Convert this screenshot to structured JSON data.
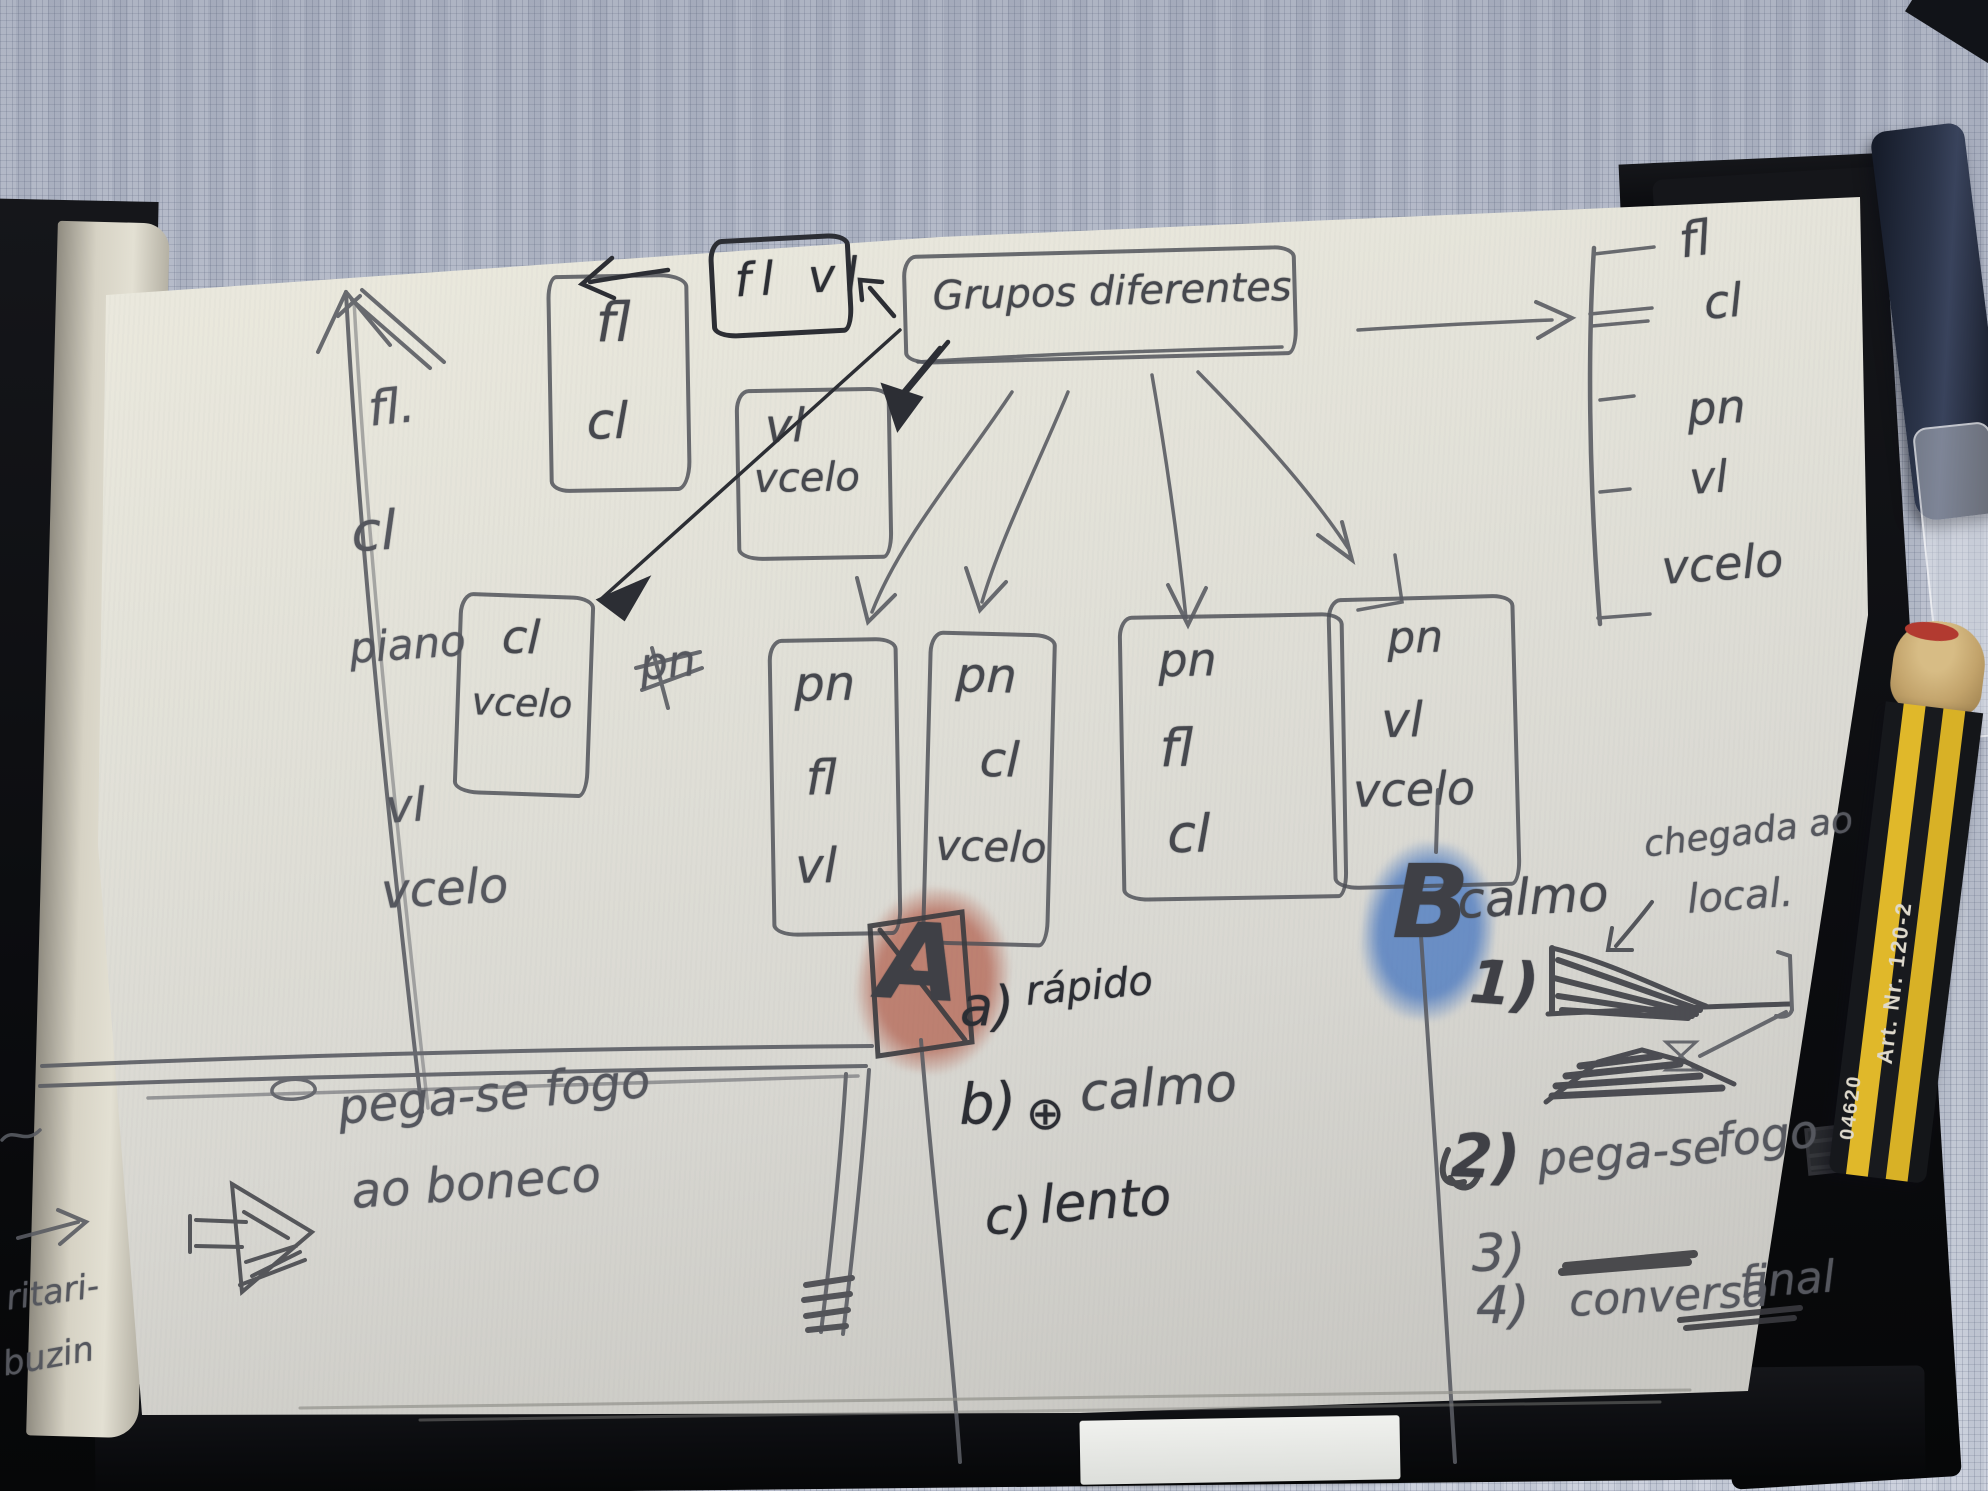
{
  "diagram": {
    "title_box": "Grupos diferentes",
    "top_small_box": "fl vl",
    "boxes": {
      "fl_cl": {
        "l1": "fl",
        "l2": "cl"
      },
      "vl_vcelo": {
        "l1": "vl",
        "l2": "vcelo"
      },
      "cl_vcelo": {
        "l1": "cl",
        "l2": "vcelo"
      },
      "pn_fl_vl": {
        "l1": "pn",
        "l2": "fl",
        "l3": "vl"
      },
      "pn_cl_vcelo": {
        "l1": "pn",
        "l2": "cl",
        "l3": "vcelo"
      },
      "pn_fl_cl": {
        "l1": "pn",
        "l2": "fl",
        "l3": "cl"
      },
      "pn_vl_vcelo": {
        "l1": "pn",
        "l2": "vl",
        "l3": "vcelo"
      }
    },
    "left_list": [
      "fl.",
      "cl",
      "piano",
      "vl",
      "vcelo"
    ],
    "right_list": [
      "fl",
      "cl",
      "pn",
      "vl",
      "vcelo"
    ],
    "crossed_note": "pn",
    "fire_note": {
      "line1": "pega-se fogo",
      "line2": "ao boneco"
    },
    "section_a": {
      "label": "A",
      "items": [
        {
          "k": "a)",
          "t": "rápido"
        },
        {
          "k": "b)",
          "sym": "⊕",
          "t": "calmo"
        },
        {
          "k": "c)",
          "t": "lento"
        }
      ]
    },
    "section_b": {
      "label": "B",
      "heading": "calmo",
      "note_line1": "chegada ao",
      "note_line2": "local.",
      "items": [
        {
          "k": "1)",
          "t1": "",
          "t2": ""
        },
        {
          "k": "2)",
          "t1": "pega-se",
          "t2": "fogo"
        },
        {
          "k": "3)",
          "t1": "",
          "t2": ""
        },
        {
          "k": "4)",
          "t1": "conversa",
          "t2": "final"
        }
      ]
    }
  },
  "side_page": {
    "line1": "ritari-",
    "line2": "buzin"
  },
  "pencil": {
    "art_label": "Art. Nr. 120-2",
    "code_label": "04620"
  },
  "colors": {
    "highlight_a": "#b14a36",
    "highlight_b": "#2b62b7",
    "graphite": "#55575e",
    "ink": "#2c2e34",
    "paper": "#e2e1da",
    "cloth": "#b4bac9"
  }
}
